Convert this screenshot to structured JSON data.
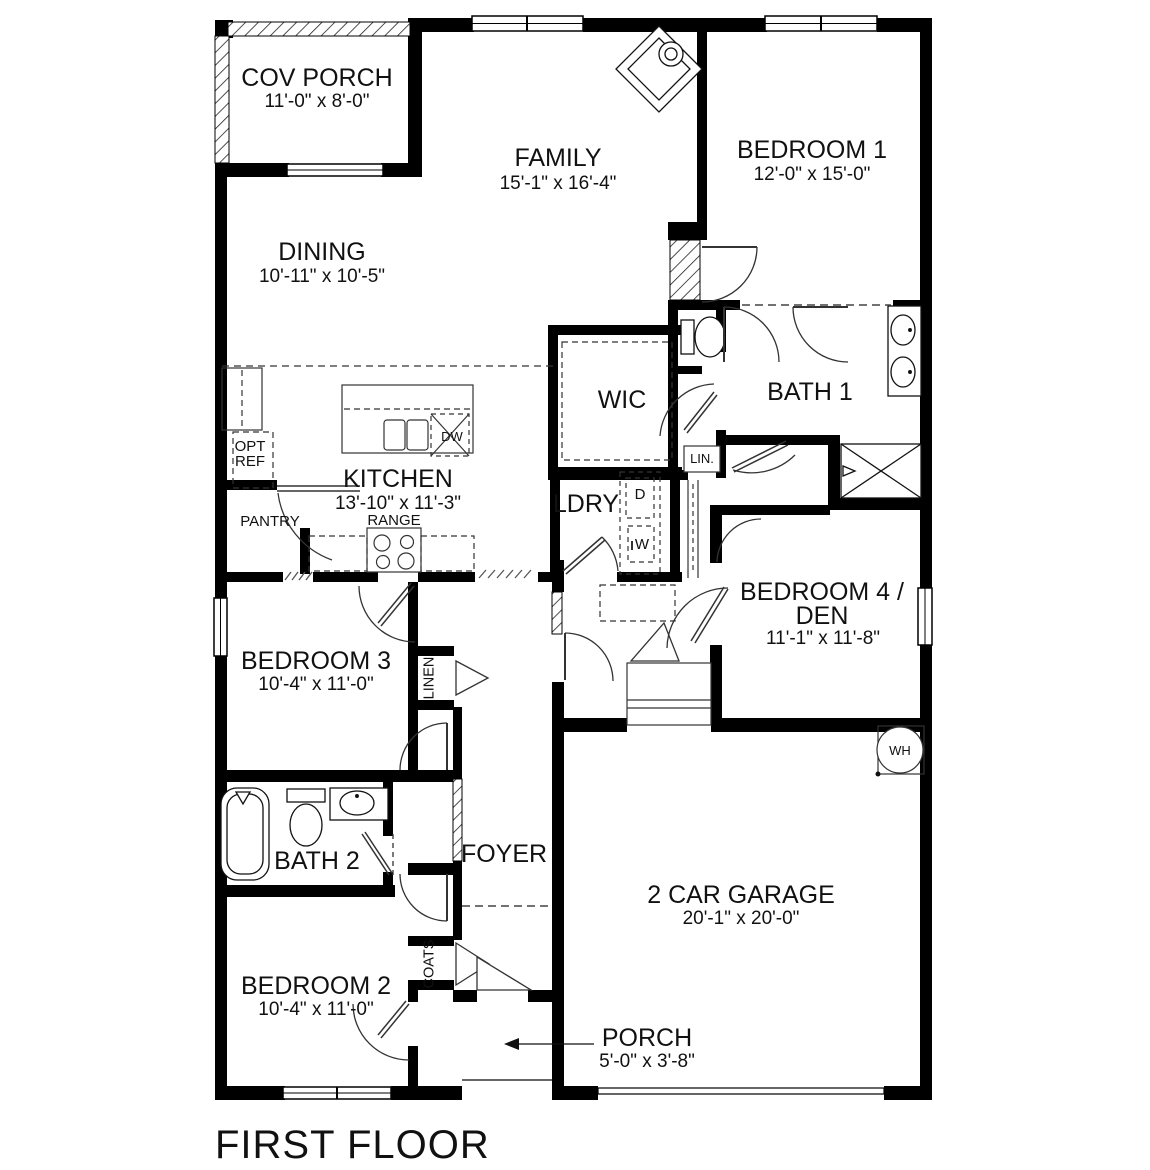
{
  "floor_title": "FIRST FLOOR",
  "rooms": {
    "cov_porch": {
      "name": "COV PORCH",
      "dims": "11'-0\" x 8'-0\""
    },
    "family": {
      "name": "FAMILY",
      "dims": "15'-1\" x 16'-4\""
    },
    "bedroom1": {
      "name": "BEDROOM 1",
      "dims": "12'-0\" x 15'-0\""
    },
    "dining": {
      "name": "DINING",
      "dims": "10'-11\" x 10'-5\""
    },
    "wic": {
      "name": "WIC"
    },
    "bath1": {
      "name": "BATH 1"
    },
    "kitchen": {
      "name": "KITCHEN",
      "dims": "13'-10\" x 11'-3\""
    },
    "laundry": {
      "name": "LDRY"
    },
    "bedroom4": {
      "name_line1": "BEDROOM 4 /",
      "name_line2": "DEN",
      "dims": "11'-1\" x 11'-8\""
    },
    "bedroom3": {
      "name": "BEDROOM 3",
      "dims": "10'-4\" x 11'-0\""
    },
    "bath2": {
      "name": "BATH 2"
    },
    "foyer": {
      "name": "FOYER"
    },
    "garage": {
      "name": "2 CAR GARAGE",
      "dims": "20'-1\" x 20'-0\""
    },
    "bedroom2": {
      "name": "BEDROOM 2",
      "dims": "10'-4\" x 11'-0\""
    },
    "porch": {
      "name": "PORCH",
      "dims": "5'-0\" x 3'-8\""
    }
  },
  "labels": {
    "opt_ref_line1": "OPT",
    "opt_ref_line2": "REF",
    "pantry": "PANTRY",
    "range": "RANGE",
    "dishwasher": "DW",
    "linen_small": "LIN.",
    "dryer": "D",
    "washer": "W",
    "linen_closet": "LINEN",
    "coats_closet": "COATS",
    "water_heater": "WH"
  },
  "colors": {
    "wall": "#000000",
    "background": "#ffffff",
    "line": "#333333"
  }
}
